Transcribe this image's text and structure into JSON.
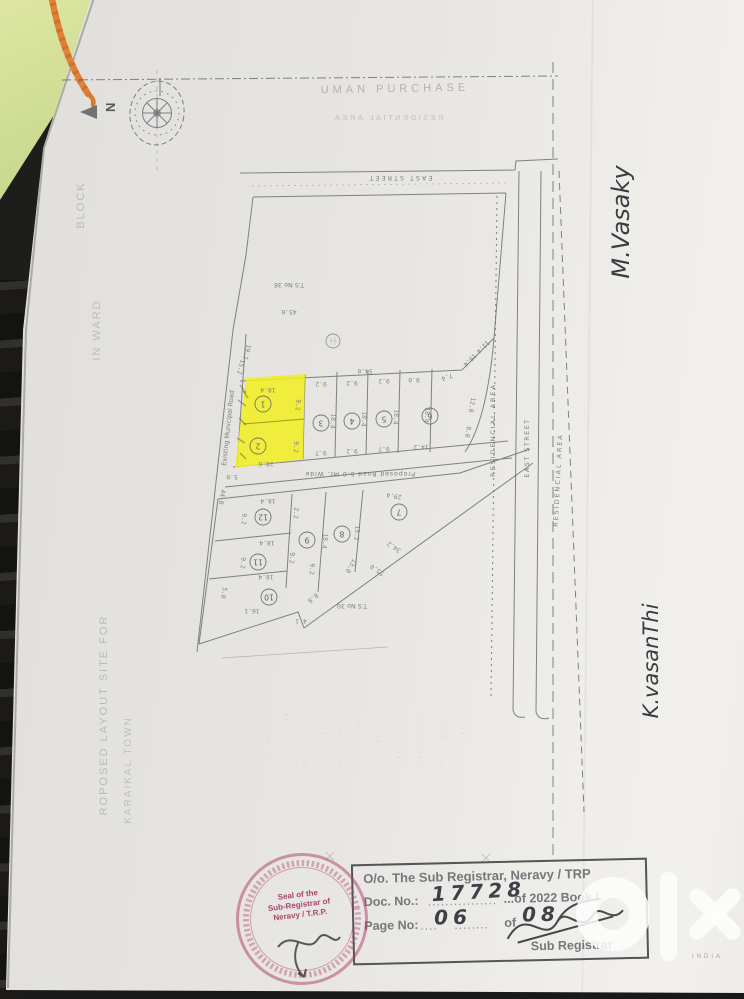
{
  "document": {
    "header": {
      "faint_title": "UMAN PURCHASE",
      "mirrored_text": "RESIDENTIAL AREA"
    },
    "plan": {
      "north_label": "N",
      "top_street": "EAST STREET",
      "survey_upper": "T.S No 36",
      "survey_lower": "T.S No 30",
      "left_road": "Existing Municipal Road",
      "mid_road": "Proposed Road 5.0 Mt. Wide",
      "residential_right_1": "RESIDENCIAL AREA",
      "east_street_right": "EAST STREET",
      "residential_right_2": "RESIDENCIAL AREA",
      "plot_numbers": [
        "1",
        "2",
        "3",
        "4",
        "5",
        "6",
        "7",
        "8",
        "9",
        "10",
        "11",
        "12"
      ],
      "dimensions": [
        "45.0",
        "54.0",
        "9.2",
        "9.2",
        "9.2",
        "8.0",
        "18.4",
        "18.4",
        "18.4",
        "18.4",
        "9.7",
        "9.2",
        "9.7",
        "14.2",
        "18.4",
        "9.2",
        "9.2",
        "28.6",
        "19.2",
        "15.2",
        "19.4",
        "11.4",
        "12.0",
        "8.0",
        "5.0",
        "44.0",
        "18.4",
        "2.2",
        "9.2",
        "18.4",
        "9.2",
        "9.2",
        "18.4",
        "5.0",
        "16.1",
        "4.1",
        "8.8",
        "9.2",
        "18.4",
        "15.2",
        "13.0",
        "34.2",
        "55.0",
        "29.4",
        "7.4"
      ]
    },
    "margins": {
      "left": [
        "BLOCK",
        "IN WARD",
        "ROPOSED LAYOUT SITE FOR",
        "KARAIKAL TOWN"
      ],
      "signature_top": "M.Vasaky",
      "signature_bottom": "K.vasanThi"
    },
    "bleed_columns": [
      "·: ·· :·",
      "· ::· · ·:",
      "·· : ·: ··:",
      "::· ·· · ··",
      "· ·: :·· ·",
      "·:· · ·: ::",
      "·· :: · ·:·",
      "· · ::· ··",
      "::· · ·: ·",
      "· ·:· :: ··",
      "·: · · ::·",
      "· :: ·:· ·"
    ],
    "registrar_box": {
      "office": "O/o. The Sub Registrar, Neravy / TRP",
      "doc_label": "Doc. No.:",
      "doc_leader": "................",
      "doc_number": "17728",
      "doc_suffix": "...of 2022 Book I",
      "page_label": "Page No:",
      "page_leader_a": "....",
      "page_number": "06",
      "page_leader_b": "........",
      "of_label": "of",
      "page_total": "08",
      "signatory": "Sub Registrar"
    },
    "seal": {
      "line1": "Seal of the",
      "line2": "Sub-Registrar of",
      "line3": "Neravy / T.R.P."
    },
    "watermark": {
      "brand": "olx",
      "sub": "INDIA"
    },
    "colors": {
      "highlight": "#f2ef1f",
      "seal_ink": "#ab3965",
      "thread": "#e08136",
      "paper": "#e9e6e2"
    }
  }
}
